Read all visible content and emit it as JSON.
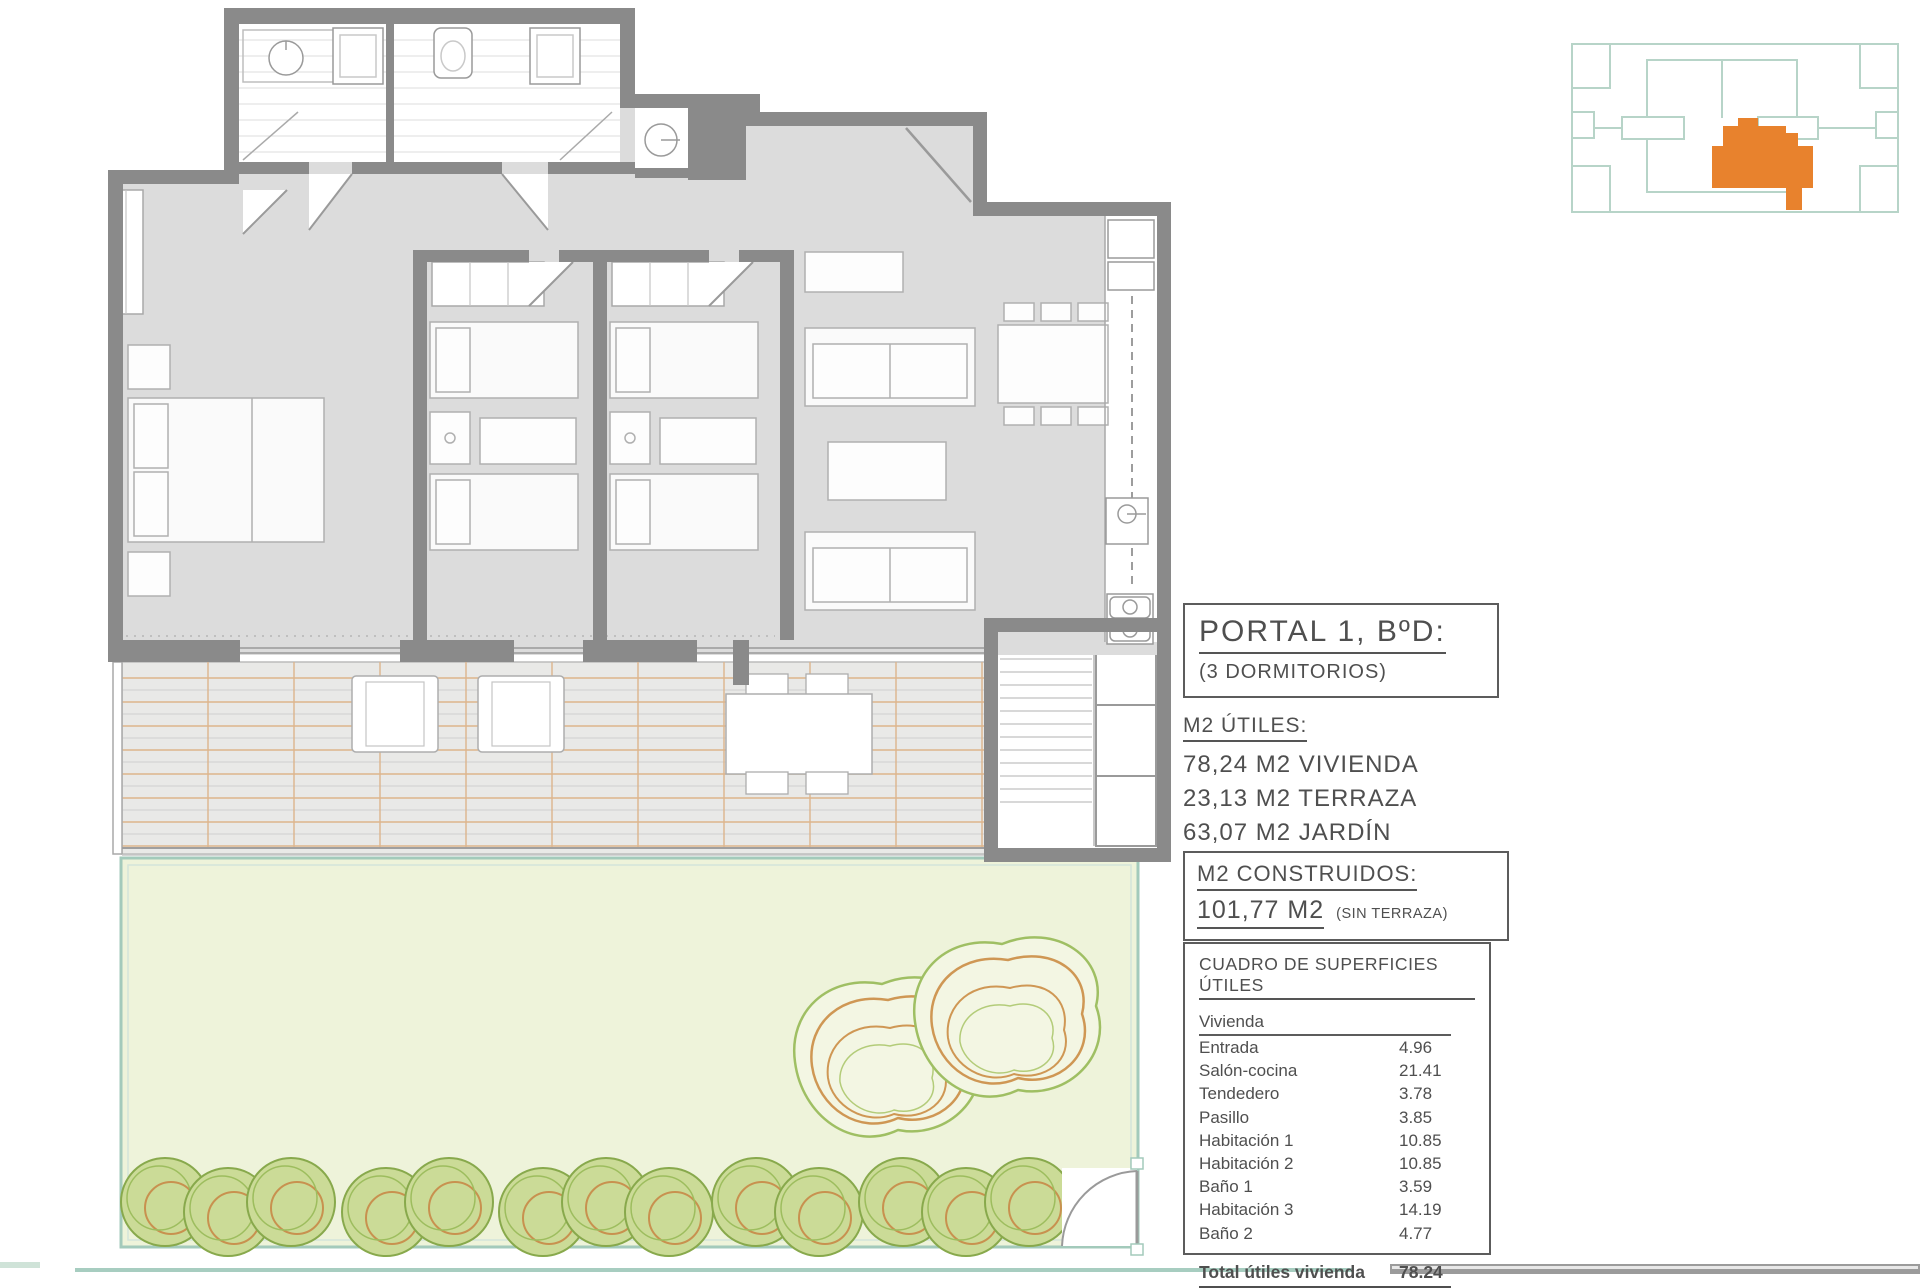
{
  "panel": {
    "portal_box": {
      "title": "PORTAL 1, BºD:",
      "subtitle": "(3 DORMITORIOS)"
    },
    "m2_utiles": {
      "heading": "M2 ÚTILES:",
      "items": [
        "78,24 M2 VIVIENDA",
        "23,13 M2 TERRAZA",
        "63,07 M2 JARDÍN"
      ]
    },
    "m2_construidos": {
      "heading": "M2 CONSTRUIDOS:",
      "value": "101,77 M2",
      "note": "(SIN TERRAZA)"
    },
    "surface_table": {
      "title": "CUADRO DE SUPERFICIES ÚTILES",
      "group": "Vivienda",
      "rows": [
        {
          "label": "Entrada",
          "value": "4.96"
        },
        {
          "label": "Salón-cocina",
          "value": "21.41"
        },
        {
          "label": "Tendedero",
          "value": "3.78"
        },
        {
          "label": "Pasillo",
          "value": "3.85"
        },
        {
          "label": "Habitación 1",
          "value": "10.85"
        },
        {
          "label": "Habitación 2",
          "value": "10.85"
        },
        {
          "label": "Baño 1",
          "value": "3.59"
        },
        {
          "label": "Habitación 3",
          "value": "14.19"
        },
        {
          "label": "Baño 2",
          "value": "4.77"
        }
      ],
      "total_label": "Total útiles vivienda",
      "total_value": "78.24"
    }
  },
  "colors": {
    "wall_gray": "#8a8a8a",
    "floor_gray": "#dcdcdc",
    "terrace_grid_orange": "#ddb58c",
    "garden_green": "#eef3da",
    "garden_border_teal": "#a3cabb",
    "site_plan_teal": "#b7d4c8",
    "unit_highlight_orange": "#e8822d",
    "text_gray": "#4f4f4f"
  }
}
